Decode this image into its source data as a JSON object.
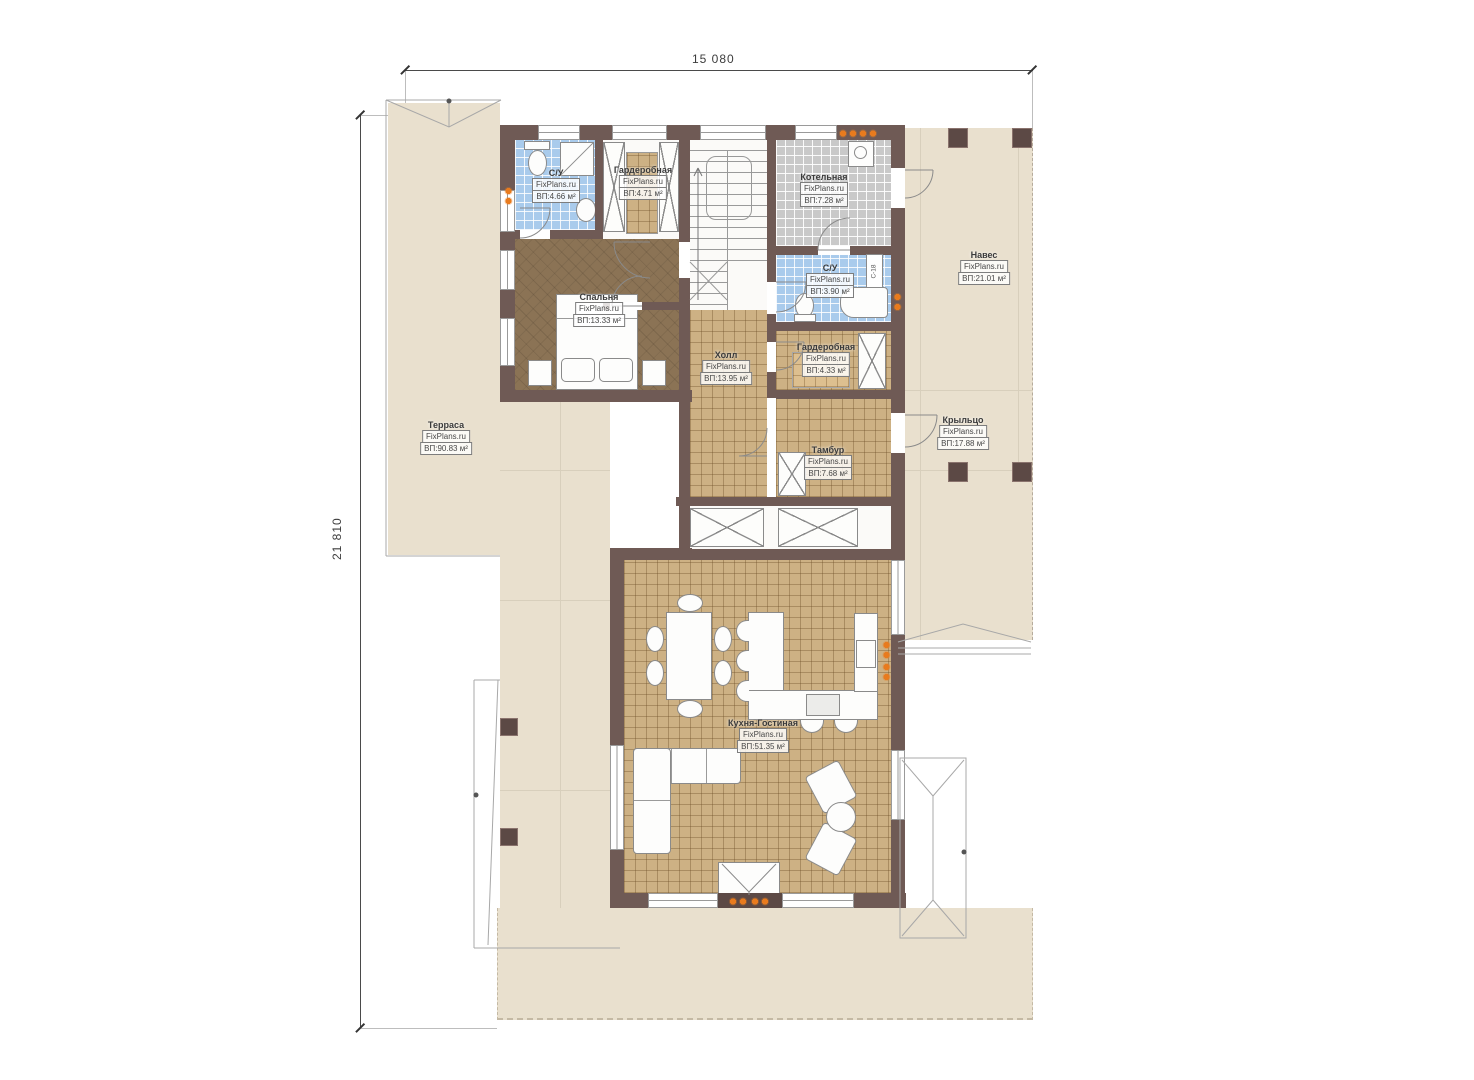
{
  "dims": {
    "width_label": "15 080",
    "height_label": "21 810"
  },
  "annotations": {
    "duct_label": "С-18"
  },
  "colors": {
    "wall": "#6f5a55",
    "col": "#5c4945",
    "tan": "#cdb184",
    "blue": "#a9cbec",
    "gray": "#c9c9c9",
    "wood": "#8b7355",
    "outdoor": "#e9e0ce",
    "orange": "#e87b1e",
    "line": "#8a8a8a"
  },
  "rooms": [
    {
      "id": "terrace",
      "name": "Терраса",
      "brand": "FixPlans.ru",
      "area": "ВП:90.83 м²"
    },
    {
      "id": "su1",
      "name": "С/У",
      "brand": "FixPlans.ru",
      "area": "ВП:4.66 м²"
    },
    {
      "id": "wardrobe1",
      "name": "Гардеробная",
      "brand": "FixPlans.ru",
      "area": "ВП:4.71 м²"
    },
    {
      "id": "boiler",
      "name": "Котельная",
      "brand": "FixPlans.ru",
      "area": "ВП:7.28 м²"
    },
    {
      "id": "canopy",
      "name": "Навес",
      "brand": "FixPlans.ru",
      "area": "ВП:21.01 м²"
    },
    {
      "id": "bedroom",
      "name": "Спальня",
      "brand": "FixPlans.ru",
      "area": "ВП:13.33 м²"
    },
    {
      "id": "su2",
      "name": "С/У",
      "brand": "FixPlans.ru",
      "area": "ВП:3.90 м²"
    },
    {
      "id": "wardrobe2",
      "name": "Гардеробная",
      "brand": "FixPlans.ru",
      "area": "ВП:4.33 м²"
    },
    {
      "id": "hall",
      "name": "Холл",
      "brand": "FixPlans.ru",
      "area": "ВП:13.95 м²"
    },
    {
      "id": "tambour",
      "name": "Тамбур",
      "brand": "FixPlans.ru",
      "area": "ВП:7.68 м²"
    },
    {
      "id": "porch",
      "name": "Крыльцо",
      "brand": "FixPlans.ru",
      "area": "ВП:17.88 м²"
    },
    {
      "id": "kitchen",
      "name": "Кухня-Гостиная",
      "brand": "FixPlans.ru",
      "area": "ВП:51.35 м²"
    }
  ]
}
